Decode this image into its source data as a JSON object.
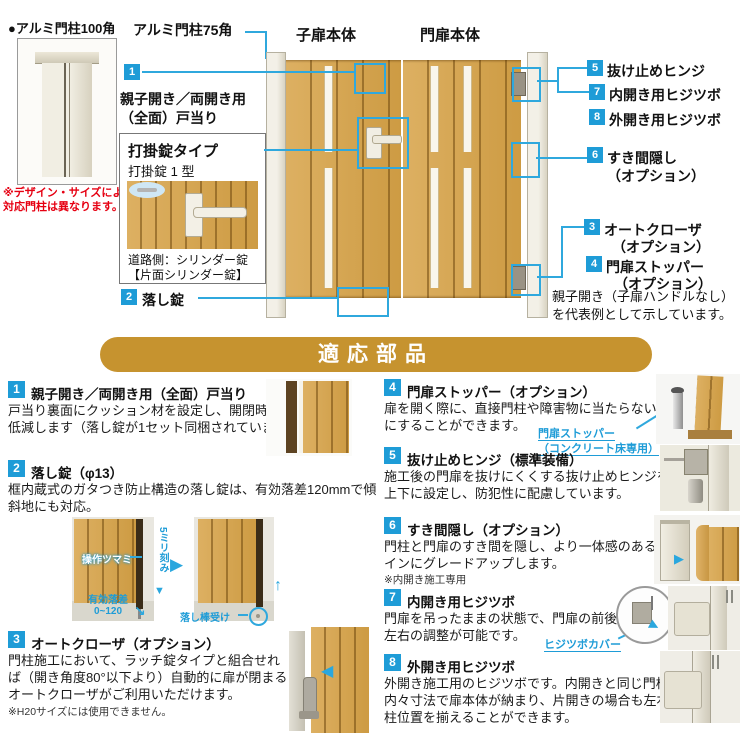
{
  "colors": {
    "accent_blue": "#1e9cd7",
    "line_blue": "#2fa8dd",
    "banner_gold": "#c6932f",
    "note_red": "#e60012",
    "wood": "#d3a04c"
  },
  "top": {
    "post100_label": "●アルミ門柱100角",
    "post100_note": [
      "※デザイン・サイズによって",
      "対応門柱は異なります。"
    ],
    "post75_label": "アルミ門柱75角",
    "child_door_label": "子扉本体",
    "main_door_label": "門扉本体",
    "callout1_num": "1",
    "callout1_lines": [
      "親子開き／両開き用",
      "（全面）戸当り"
    ],
    "lock_box": {
      "title": "打掛錠タイプ",
      "subtitle": "打掛錠 1 型",
      "captions": [
        "道路側：シリンダー錠",
        "【片面シリンダー錠】"
      ]
    },
    "callout2_num": "2",
    "callout2_label": "落し錠",
    "right_labels": [
      {
        "num": "5",
        "lines": [
          "抜け止めヒンジ"
        ]
      },
      {
        "num": "7",
        "lines": [
          "内開き用ヒジツボ"
        ]
      },
      {
        "num": "8",
        "lines": [
          "外開き用ヒジツボ"
        ]
      },
      {
        "num": "6",
        "lines": [
          "すき間隠し",
          "（オプション）"
        ]
      },
      {
        "num": "3",
        "lines": [
          "オートクローザ",
          "（オプション）"
        ]
      },
      {
        "num": "4",
        "lines": [
          "門扉ストッパー",
          "（オプション）"
        ]
      }
    ],
    "representative_note": [
      "親子開き（子扉ハンドルなし）",
      "を代表例として示しています。"
    ]
  },
  "banner": {
    "title": "適応部品"
  },
  "parts": {
    "item1": {
      "num": "1",
      "heading": "親子開き／両開き用（全面）戸当り",
      "body": [
        "戸当り裏面にクッション材を設定し、開閉時の音を",
        "低減します（落し錠が1セット同梱されています）。"
      ]
    },
    "item2": {
      "num": "2",
      "heading": "落し錠（φ13）",
      "body": [
        "框内蔵式のガタつき防止構造の落し錠は、有効落差120mmで傾",
        "斜地にも対応。"
      ]
    },
    "item3": {
      "num": "3",
      "heading": "オートクローザ（オプション）",
      "body": [
        "門柱施工において、ラッチ錠タイプと組合せれ",
        "ば（開き角度80°以下より）自動的に扉が閉まる",
        "オートクローザがご利用いただけます。"
      ],
      "note": "※H20サイズには使用できません。"
    },
    "item4": {
      "num": "4",
      "heading": "門扉ストッパー（オプション）",
      "body": [
        "扉を開く際に、直接門柱や障害物に当たらないよう",
        "にすることができます。"
      ],
      "caption": [
        "門扉ストッパー",
        "（コンクリート床専用）"
      ]
    },
    "item5": {
      "num": "5",
      "heading": "抜け止めヒンジ（標準装備）",
      "body": [
        "施工後の門扉を抜けにくくする抜け止めヒンジを",
        "上下に設定し、防犯性に配慮しています。"
      ]
    },
    "item6": {
      "num": "6",
      "heading": "すき間隠し（オプション）",
      "body": [
        "門柱と門扉のすき間を隠し、より一体感のあるデザ",
        "インにグレードアップします。"
      ],
      "note": "※内開き施工専用"
    },
    "item7": {
      "num": "7",
      "heading": "内開き用ヒジツボ",
      "body": [
        "門扉を吊ったままの状態で、門扉の前後",
        "左右の調整が可能です。"
      ],
      "caption": "ヒジツボカバー"
    },
    "item8": {
      "num": "8",
      "heading": "外開き用ヒジツボ",
      "body": [
        "外開き施工用のヒジツボです。内開きと同じ門柱の",
        "内々寸法で扉本体が納まり、片開きの場合も左右の",
        "柱位置を揃えることができます。"
      ]
    }
  },
  "figures": {
    "drop_lock": {
      "knob_label": "操作ツマミ",
      "pitch_label": "5ミリ刻み",
      "drop_label": [
        "有効落差",
        "0~120"
      ],
      "receiver_label": "落し棒受け"
    }
  }
}
